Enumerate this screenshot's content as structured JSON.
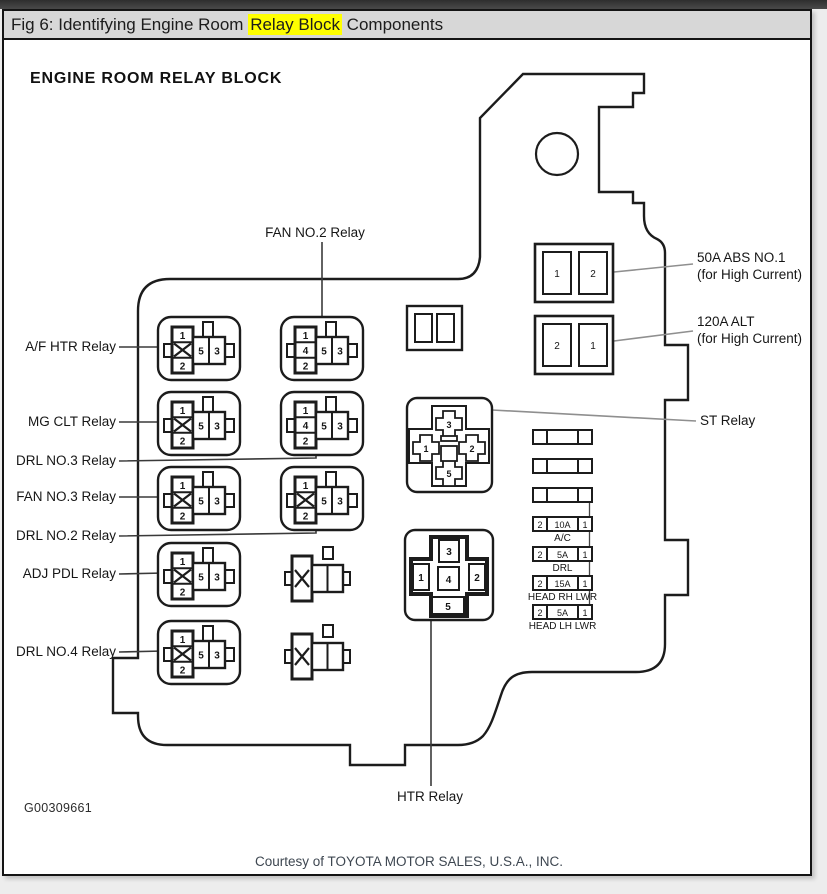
{
  "window": {
    "title_prefix": "Fig 6: Identifying Engine Room ",
    "title_highlight": "Relay Block",
    "title_suffix": " Components",
    "highlight_color": "#ffff00"
  },
  "diagram": {
    "heading": "ENGINE ROOM RELAY BLOCK",
    "part_number": "G00309661",
    "credit": "Courtesy of TOYOTA MOTOR SALES, U.S.A., INC.",
    "relays": [
      {
        "id": "af-htr",
        "label": "A/F HTR Relay",
        "pins": [
          "1",
          "2",
          "5",
          "3"
        ]
      },
      {
        "id": "fan-no2",
        "label": "FAN NO.2 Relay",
        "pins": [
          "1",
          "4",
          "2",
          "5",
          "3"
        ]
      },
      {
        "id": "mg-clt",
        "label": "MG CLT Relay",
        "pins": [
          "1",
          "2",
          "5",
          "3"
        ]
      },
      {
        "id": "drl-no3",
        "label": "DRL NO.3 Relay",
        "pins": [
          "1",
          "4",
          "2",
          "5",
          "3"
        ]
      },
      {
        "id": "fan-no3",
        "label": "FAN NO.3 Relay",
        "pins": [
          "1",
          "2",
          "5",
          "3"
        ]
      },
      {
        "id": "drl-no2",
        "label": "DRL NO.2 Relay",
        "pins": [
          "1",
          "2",
          "5",
          "3"
        ]
      },
      {
        "id": "adj-pdl",
        "label": "ADJ PDL Relay",
        "pins": [
          "1",
          "2",
          "5",
          "3"
        ]
      },
      {
        "id": "drl-no4",
        "label": "DRL NO.4 Relay",
        "pins": [
          "1",
          "2",
          "5",
          "3"
        ]
      },
      {
        "id": "st",
        "label": "ST Relay",
        "pins": [
          "3",
          "1",
          "2",
          "5"
        ]
      },
      {
        "id": "htr",
        "label": "HTR Relay",
        "pins": [
          "3",
          "1",
          "4",
          "2",
          "5"
        ]
      }
    ],
    "high_current_fuses": [
      {
        "id": "abs-no1",
        "cells": [
          "1",
          "2"
        ],
        "label_line1": "50A ABS NO.1",
        "label_line2": "(for High Current)"
      },
      {
        "id": "alt",
        "cells": [
          "2",
          "1"
        ],
        "label_line1": "120A ALT",
        "label_line2": "(for High Current)"
      }
    ],
    "mini_fuses": [
      {
        "id": "ac",
        "cells": [
          "2",
          "10A",
          "1"
        ],
        "label": "A/C"
      },
      {
        "id": "drl",
        "cells": [
          "2",
          "5A",
          "1"
        ],
        "label": "DRL"
      },
      {
        "id": "head-rh-lwr",
        "cells": [
          "2",
          "15A",
          "1"
        ],
        "label": "HEAD RH LWR"
      },
      {
        "id": "head-lh-lwr",
        "cells": [
          "2",
          "5A",
          "1"
        ],
        "label": "HEAD LH LWR"
      }
    ]
  }
}
